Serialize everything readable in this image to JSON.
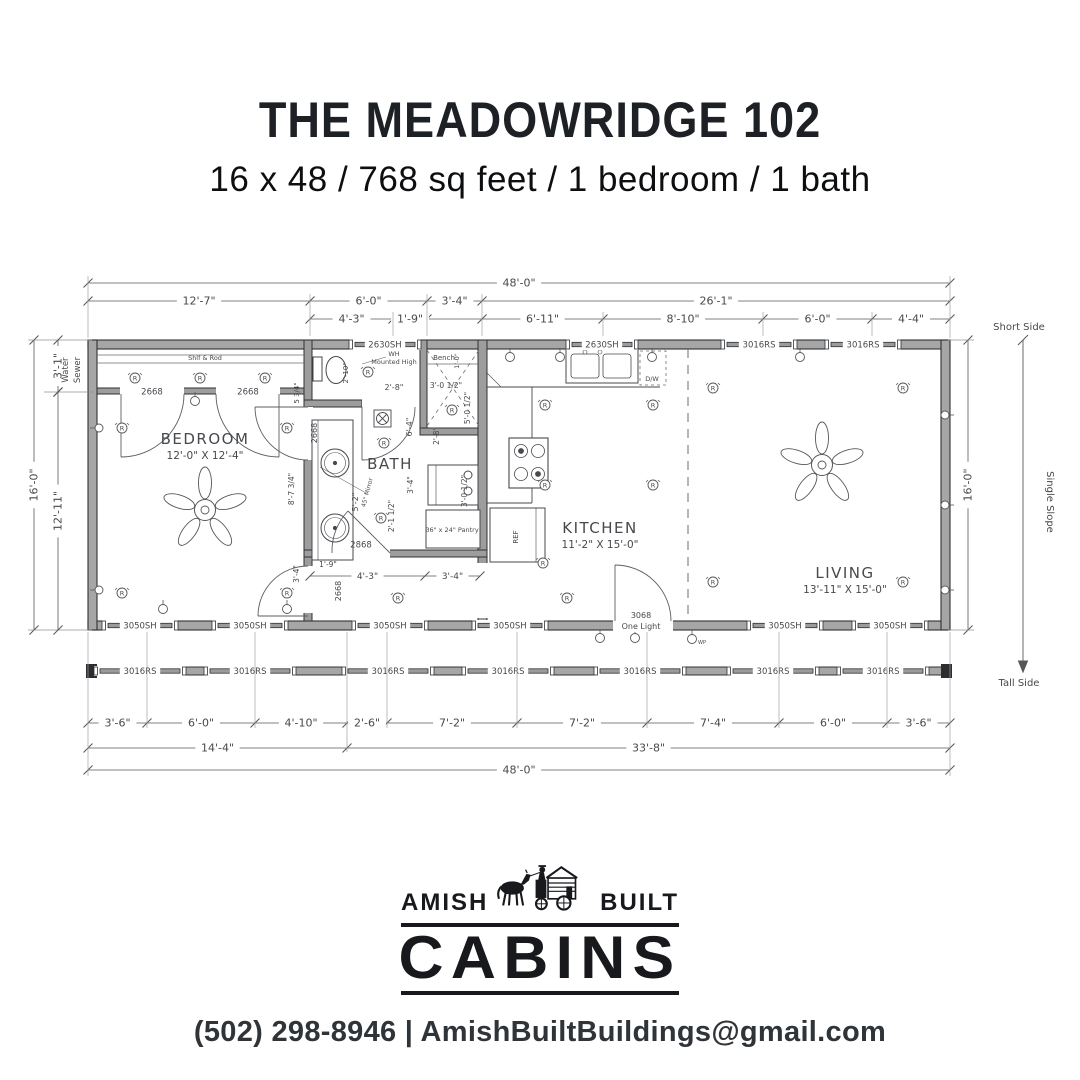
{
  "header": {
    "title": "THE MEADOWRIDGE 102",
    "subtitle": "16 x 48 / 768 sq feet / 1 bedroom / 1 bath"
  },
  "plan": {
    "dims": {
      "top_total": "48'-0\"",
      "top_row2": [
        "12'-7\"",
        "6'-0\"",
        "3'-4\"",
        "26'-1\""
      ],
      "top_row3": [
        "4'-3\"",
        "1'-9\"",
        "6'-11\"",
        "8'-10\"",
        "6'-0\"",
        "4'-4\""
      ],
      "bottom_row1": [
        "3'-6\"",
        "6'-0\"",
        "4'-10\"",
        "2'-6\"",
        "7'-2\"",
        "7'-2\"",
        "7'-4\"",
        "6'-0\"",
        "3'-6\""
      ],
      "bottom_sub": [
        "14'-4\"",
        "33'-8\""
      ],
      "bottom_total": "48'-0\"",
      "left_total": "16'-0\"",
      "left_upper": "3'-1\"",
      "left_lower": "12'-11\"",
      "right_total": "16'-0\""
    },
    "side": {
      "top": "Short Side",
      "middle": "Single Slope",
      "bottom": "Tall Side",
      "water1": "Water",
      "water2": "Sewer"
    },
    "rooms": [
      {
        "name": "BEDROOM",
        "size": "12'-0\" X 12'-4\""
      },
      {
        "name": "BATH",
        "size": ""
      },
      {
        "name": "KITCHEN",
        "size": "11'-2\" X 15'-0\""
      },
      {
        "name": "LIVING",
        "size": "13'-11\" X 15'-0\""
      }
    ],
    "window_types": {
      "sh2630": "2630SH",
      "rs3016": "3016RS",
      "sh3050": "3050SH"
    },
    "doors": {
      "closet_a": "2668",
      "closet_b": "2668",
      "bath_hall1": "2668",
      "bath_hall2": "2668",
      "bath": "2868",
      "main_a": "3068",
      "main_b": "One Light"
    },
    "notes": {
      "closet_shelf": "Shlf & Rod",
      "wh_line1": "WH",
      "wh_line2": "Mounted High",
      "bench": "Bench",
      "pantry": "36\" x 24\" Pantry",
      "mirror": "45\" Mirror",
      "dw": "D/W",
      "ref": "REF",
      "wp": "WP"
    },
    "small": {
      "toilet": "2'-10\"",
      "bench_depth": "1'-0\"",
      "shower_w": "3'-0 1/2\"",
      "shower_h": "5'-0 1/2\"",
      "shower_d": "2'-8\"",
      "hall_w": "2'-8\"",
      "hall_h": "6'-4\"",
      "vanity": "5'-2\"",
      "wd_w": "3'-4\"",
      "wd_d": "3'-0 1/2\"",
      "door_clr": "2'-1 1/2\"",
      "hall_clr": "1'-9\"",
      "wall_a1": "5 3/4\"",
      "wall_a2": "8'-7 3/4\"",
      "wall_a3": "3'-4\"",
      "bath_row": [
        "4'-3\"",
        "3'-4\""
      ]
    },
    "symbols": {
      "receptacle": "R"
    }
  },
  "logo": {
    "word_left": "AMISH",
    "word_right": "BUILT",
    "word_main": "CABINS"
  },
  "contact": "(502) 298-8946 | AmishBuiltBuildings@gmail.com",
  "colors": {
    "ink": "#46494d",
    "wall_fill": "#a6a6a6",
    "wall_stroke": "#2e3134",
    "line": "#55585b"
  }
}
